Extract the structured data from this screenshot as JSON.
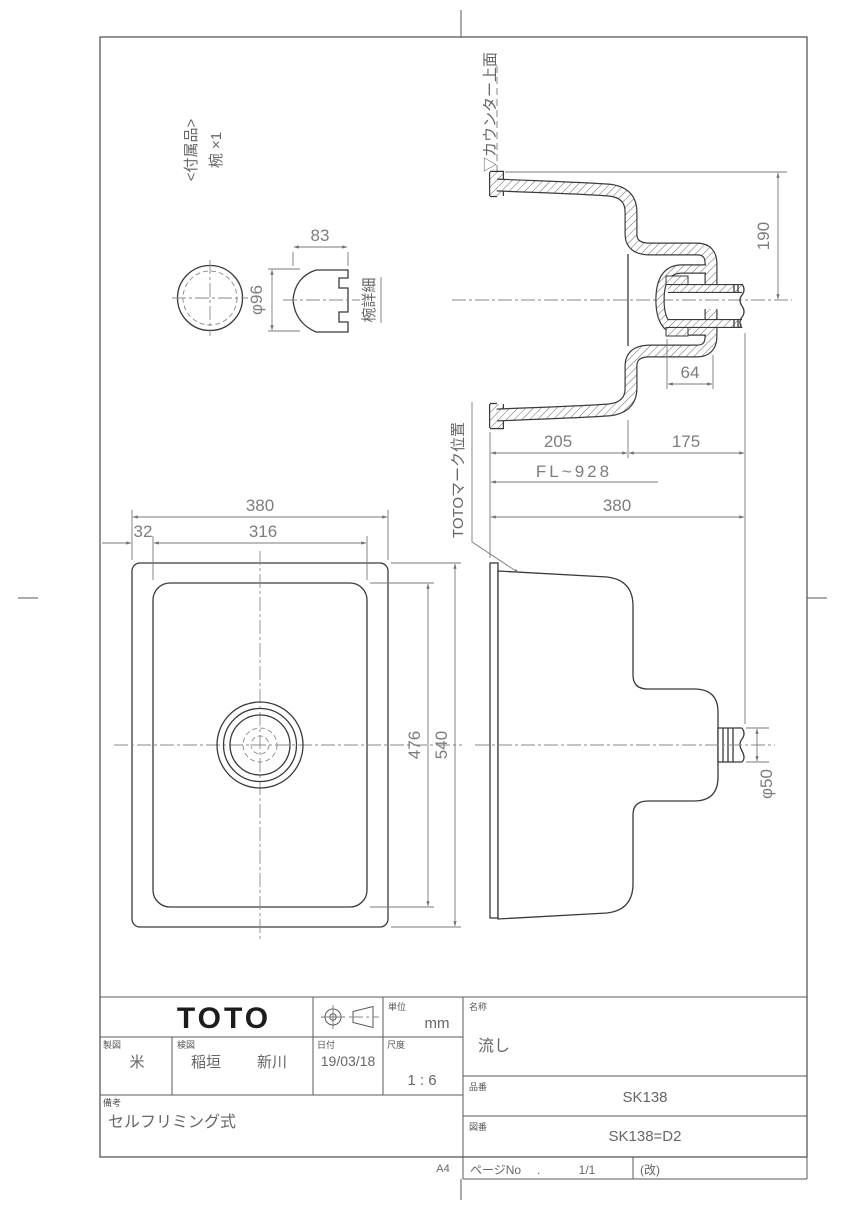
{
  "page": {
    "size_label": "A4",
    "page_no_label": "ページNo",
    "page_no_dot": ".",
    "page_no_value": "1/1",
    "revision_label": "(改)"
  },
  "title_block": {
    "logo": "TOTO",
    "unit_label": "単位",
    "unit_value": "mm",
    "drafter_label": "製図",
    "drafter_value": "米",
    "checker_label": "検図",
    "checker_value_1": "稲垣",
    "checker_value_2": "新川",
    "date_label": "日付",
    "date_value": "19/03/18",
    "scale_label": "尺度",
    "scale_value": "1 : 6",
    "remarks_label": "備考",
    "remarks_value": "セルフリミング式",
    "name_label": "名称",
    "name_value": "流し",
    "product_label": "品番",
    "product_value": "SK138",
    "drawing_label": "図番",
    "drawing_value": "SK138=D2"
  },
  "accessory": {
    "header_1": "<付属品>",
    "header_2": "椀 ×1",
    "detail_label": "椀詳細",
    "dims": {
      "width": "83",
      "diameter": "φ96"
    }
  },
  "section_view": {
    "counter_label": "▽カウンター上面",
    "mark_label": "TOTOマーク位置",
    "dims": {
      "depth_total": "190",
      "drain_width": "64",
      "front": "205",
      "rear": "175",
      "floor_level": "FL~928"
    }
  },
  "side_view": {
    "dims": {
      "depth": "380",
      "outlet": "φ50"
    }
  },
  "plan_view": {
    "dims": {
      "width_outer": "380",
      "width_inner": "316",
      "offset": "32",
      "length_inner": "476",
      "length_outer": "540"
    }
  },
  "colors": {
    "line": "#3a3a3a",
    "dim": "#7d7d7d",
    "bg": "#ffffff"
  }
}
